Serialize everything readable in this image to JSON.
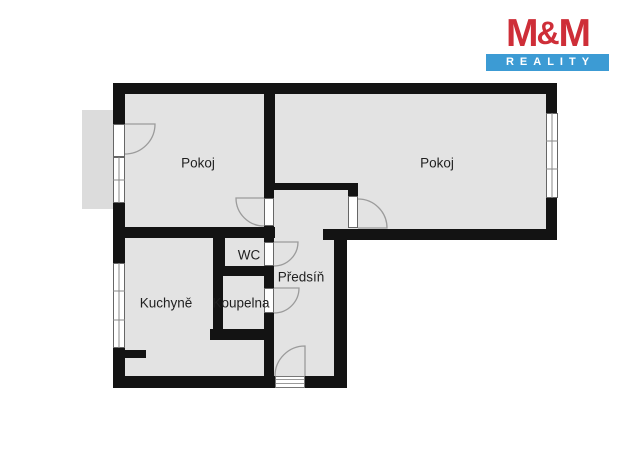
{
  "logo": {
    "name_left": "M",
    "name_amp": "&",
    "name_right": "M",
    "tagline": "REALITY"
  },
  "floor_plan": {
    "rooms": {
      "pokoj_left": "Pokoj",
      "pokoj_right": "Pokoj",
      "kuchyne": "Kuchyně",
      "koupelna": "Koupelna",
      "wc": "WC",
      "predsin": "Předsíň"
    }
  },
  "colors": {
    "background": "#ffffff",
    "floor": "#e3e3e3",
    "balcony": "#dcdcdc",
    "wall": "#131313",
    "arc": "#9b9b9b",
    "window_border": "#666666",
    "label": "#1f1f1f",
    "logo_red": "#ce2e38",
    "logo_blue": "#3c9bd4"
  }
}
